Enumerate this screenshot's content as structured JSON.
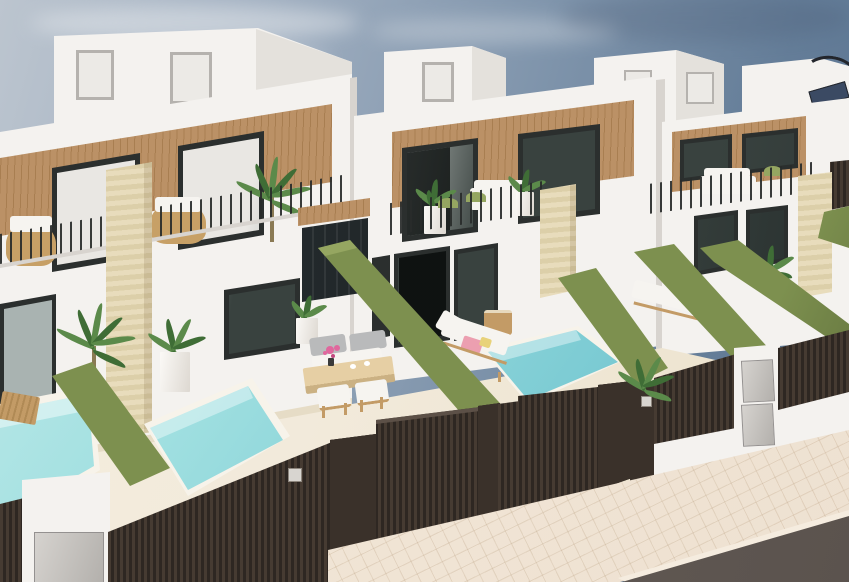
{
  "scene": {
    "type": "architectural-3d-render",
    "subject": "Row of modern two-storey white villas with wood-slat facade accents, rooftop terraces, balconies, private patios with turquoise plunge pools, artificial-grass covered dividing walls, dark slatted entrance gates and a paved sidewalk with road in the foreground",
    "objects": [
      "sky",
      "clouds",
      "rooftop-volumes",
      "rooftop-pergola",
      "white-facades",
      "wood-slat-panels",
      "dark-framed-windows",
      "balcony-railings",
      "outdoor-sofas",
      "wicker-chairs",
      "travertine-columns",
      "entrance-canopy",
      "patios",
      "plunge-pools",
      "sun-loungers",
      "pink-towels",
      "dining-set",
      "potted-plants",
      "palm-plants",
      "green-hedge-walls",
      "dark-slatted-fences",
      "gates",
      "gate-pillars",
      "intercom-plates",
      "mailbox-pillar",
      "storage-box",
      "sidewalk",
      "road"
    ],
    "text_visible": ""
  },
  "palette": {
    "sky_deep": "#5a7390",
    "sky_mid": "#8095ac",
    "sky_light": "#bcc5cf",
    "cloud": "#e2e6ea",
    "wall_white": "#f4f2ef",
    "wall_shade": "#e4e1dc",
    "seam": "#d8d4cf",
    "wood": "#bb9166",
    "wood_dark": "#a87e51",
    "frame": "#2b2f2e",
    "glass_dark": "#39423f",
    "glass_light": "#c7ccc9",
    "curtain": "#e9e7e3",
    "travertine": "#e8dcbc",
    "travertine_dark": "#dccfa9",
    "railing": "#2c2f2e",
    "hedge": "#7d904f",
    "hedge_light": "#95a661",
    "hedge_dark": "#63743e",
    "pool_light": "#cdeeec",
    "pool_mid": "#9fdfe0",
    "pool_deep": "#73c6d0",
    "pool_coping": "#f7f3ea",
    "patio": "#f2eadb",
    "patio_shade": "#e6dcc6",
    "fence": "#3a312a",
    "fence_slat": "#463b32",
    "fence_dark": "#2e2722",
    "fence_hi": "#5c5047",
    "metal_panel": "#c9c6c2",
    "sidewalk": "#eee1d1",
    "sidewalk_line": "#d9c9b4",
    "road": "#5b534e",
    "curb": "#f5ecdf",
    "lounger_wood": "#c39b66",
    "cushion_white": "#f6f4f0",
    "cushion_gray": "#b9babb",
    "towel_pink": "#ec9fb0",
    "towel_yellow": "#e8d27a",
    "flower_pink": "#e0679d",
    "plant_green": "#5b8a4a",
    "plant_dark": "#3f6d36",
    "trunk": "#8a7a54",
    "wicker": "#c7a066"
  }
}
